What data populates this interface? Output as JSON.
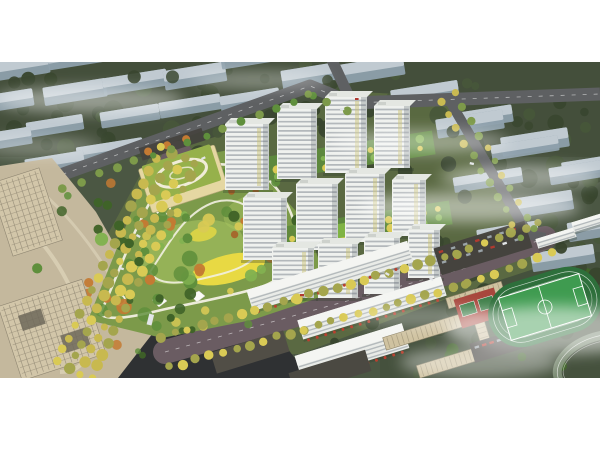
{
  "meta": {
    "title": "Residential masterplan aerial rendering",
    "image_type": "architectural bird's-eye rendering, letterboxed on white",
    "canvas": {
      "width": 600,
      "height": 450
    },
    "content_band": {
      "top": 62,
      "height": 316
    },
    "letterbox_color": "#ffffff"
  },
  "scene": {
    "description": "Aerial bird's-eye architectural rendering of a residential development: a cluster of white high-rise apartment towers with green courtyards, a large landscaped central park with winding white paths and a yellow flower meadow, a kindergarten with a green roof, retail slabs with red awnings, a school campus with running track, football field and red basketball courts, tree-lined boulevards with yellow trees, beige office blocks at lower left, all surrounded by faded grey-blue context city blocks under wisps of white fog",
    "elements": [
      {
        "id": "context-city",
        "label": "Faded grey-blue context city blocks on dark olive ground",
        "count": 27
      },
      {
        "id": "road-network",
        "label": "Boulevards and perimeter roads with street trees"
      },
      {
        "id": "office-plaza",
        "label": "Beige office buildings and plaza, lower left",
        "count": 2
      },
      {
        "id": "central-park",
        "label": "Central park with winding paths, yellow meadow, pavilions"
      },
      {
        "id": "kindergarten",
        "label": "Kindergarten with green roof and white rooftop loop"
      },
      {
        "id": "residential-towers",
        "label": "White residential high-rise towers",
        "count": 12
      },
      {
        "id": "retail-strip",
        "label": "Mid-rise retail slabs with red awnings",
        "count": 3
      },
      {
        "id": "school-campus",
        "label": "School buildings with ribbed beige roofs",
        "count": 4
      },
      {
        "id": "sports-field",
        "label": "Football pitch with track and red basketball courts"
      },
      {
        "id": "fog-layer",
        "label": "White fog wisps over the scene"
      }
    ]
  },
  "palette": {
    "context_ground": "#4b5743",
    "context_ground_dark": "#3c4834",
    "site_ground": "#5c6b42",
    "context_building_top": "#c3ccd3",
    "context_building_side": "#8ea0ac",
    "context_tree_dark": "#39462f",
    "context_tree_mid": "#47573a",
    "road_asphalt": "#5e6062",
    "road_dark": "#2f3133",
    "boulevard": "#6a5c62",
    "tree_yellow": "#d9ca55",
    "tree_olive": "#a4a54d",
    "tree_green": "#5f8f3c",
    "tree_green_light": "#82b250",
    "tree_green_deep": "#3f6328",
    "tree_orange": "#c47a33",
    "tree_orange_deep": "#a85f27",
    "park_grass": "#7c9a4a",
    "lawn_light": "#a9c662",
    "meadow_yellow": "#e8d943",
    "path_white": "#f2efe2",
    "tower_face": "#eff1ee",
    "tower_band": "#9fa6ab",
    "tower_shade": "#5a646a",
    "roof_cap": "#e4e7e2",
    "balcony_green": "#c9c26e",
    "kindergarten_roof": "#96b14b",
    "kindergarten_wall": "#e5d7a2",
    "plaza": "#c4b89d",
    "plaza_path": "#dcd2b8",
    "office_wall": "#d2c6a9",
    "office_grid": "#8f8672",
    "office_roof_inset": "#6e685a",
    "school_roof": "#cfc2a0",
    "school_rib": "#a3987b",
    "parking_dark": "#45433e",
    "court_red": "#a8473d",
    "court_green": "#3f7f49",
    "field_green": "#3f9b50",
    "track_green": "#2e6f3b",
    "track_grey": "#7e8f77",
    "awning_red": "#b8402f",
    "slab_white": "#e9ebe7",
    "dark_block": "#514e46",
    "fog_white": "#ffffff",
    "pond_blue": "#5f9fc0",
    "car_white": "#e2e5e7",
    "car_red": "#b03a30",
    "line_white": "#ffffff"
  }
}
